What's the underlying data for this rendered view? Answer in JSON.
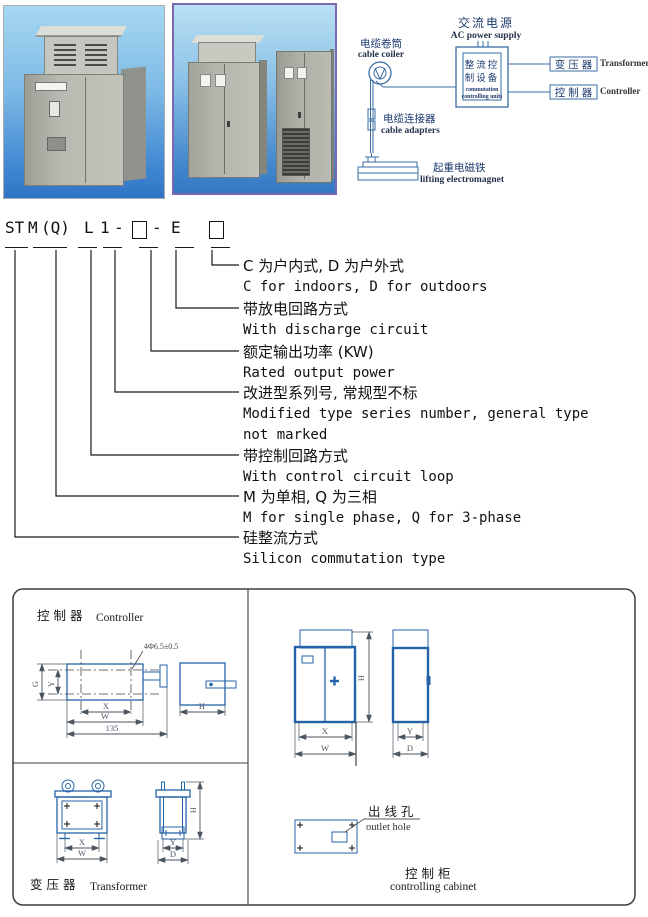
{
  "diagram": {
    "ac_power_cn": "交流电源",
    "ac_power_en": "AC power supply",
    "cable_coiler_cn": "电缆卷筒",
    "cable_coiler_en": "cable coiler",
    "unit_cn_line1": "整流控",
    "unit_cn_line2": "制设备",
    "unit_en_line1": "commutation",
    "unit_en_line2": "controlling units",
    "transformer_cn": "变压器",
    "transformer_en": "Transformer",
    "controller_cn": "控制器",
    "controller_en": "Controller",
    "cable_adapters_cn": "电缆连接器",
    "cable_adapters_en": "cable adapters",
    "electromagnet_cn": "起重电磁铁",
    "electromagnet_en": "lifting electromagnet"
  },
  "model_code": {
    "p_st": "ST",
    "p_m": "M",
    "p_q": "(Q)",
    "p_l": "L",
    "p_1": "1",
    "dash": "-",
    "p_e": "E",
    "items": [
      {
        "cn": "C 为户内式, D 为户外式",
        "en": "C for indoors, D for outdoors"
      },
      {
        "cn": "带放电回路方式",
        "en": "With discharge circuit"
      },
      {
        "cn": "额定输出功率 (KW)",
        "en": "Rated output power"
      },
      {
        "cn": "改进型系列号, 常规型不标",
        "en": "Modified type series number, general type",
        "en2": "not marked"
      },
      {
        "cn": "带控制回路方式",
        "en": "With control circuit loop"
      },
      {
        "cn": "M 为单相, Q 为三相",
        "en": "M for single phase, Q for 3-phase"
      },
      {
        "cn": "硅整流方式",
        "en": "Silicon commutation type"
      }
    ]
  },
  "drawings": {
    "controller_cn": "控 制 器",
    "controller_en": "Controller",
    "transformer_cn": "变 压 器",
    "transformer_en": "Transformer",
    "outlet_cn": "出 线 孔",
    "outlet_en": "outlet hole",
    "cabinet_cn": "控 制 柜",
    "cabinet_en": "controlling cabinet",
    "hole_note": "4Φ6.5±0.5",
    "dims": {
      "G": "G",
      "X": "X",
      "Y": "Y",
      "W": "W",
      "H": "H",
      "D": "D",
      "n135": "135"
    }
  },
  "colors": {
    "blue": "#2563a8",
    "diag": "#3a6ea5",
    "navy": "#1c3a6e",
    "dim": "#4c5660",
    "frame": "#3f3f3f",
    "photo_border": "#7b68b0"
  }
}
